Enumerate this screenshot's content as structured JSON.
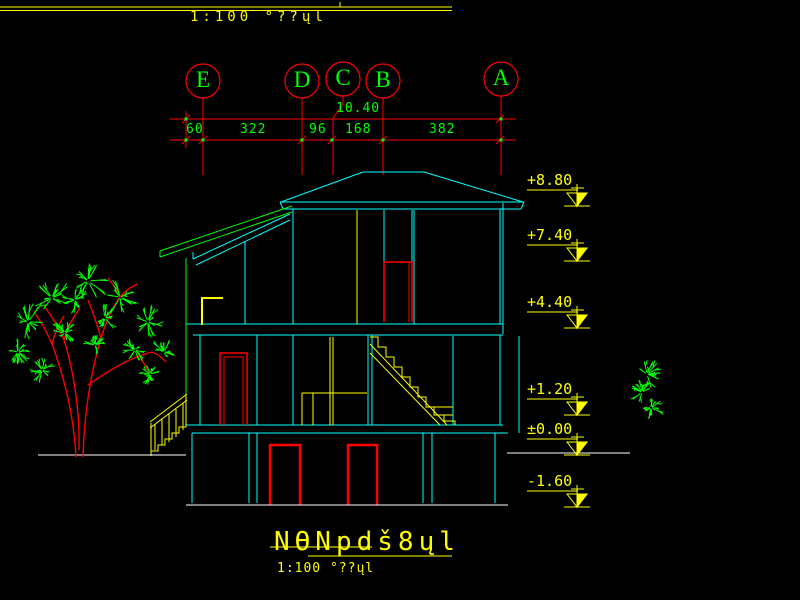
{
  "colors": {
    "background": "#000000",
    "grid_red": "#ff0000",
    "dim_green": "#00ff00",
    "building_cyan": "#00ffff",
    "annotation_yellow": "#ffff00",
    "ground_white": "#ffffff"
  },
  "top_bar": {
    "scale_text": "1:100 °??ųl"
  },
  "grid_bubbles": [
    {
      "label": "E"
    },
    {
      "label": "D"
    },
    {
      "label": "C"
    },
    {
      "label": "B"
    },
    {
      "label": "A"
    }
  ],
  "dimensions": {
    "overall": "10.40",
    "segments": [
      "60",
      "322",
      "96",
      "168",
      "382"
    ]
  },
  "elevation_markers": [
    {
      "label": "+8.80"
    },
    {
      "label": "+7.40"
    },
    {
      "label": "+4.40"
    },
    {
      "label": "+1.20"
    },
    {
      "label": "±0.00"
    },
    {
      "label": "-1.60"
    }
  ],
  "title_block": {
    "title": "NϴNpdš8ųl",
    "scale_text": "1:100 °??ųl"
  }
}
